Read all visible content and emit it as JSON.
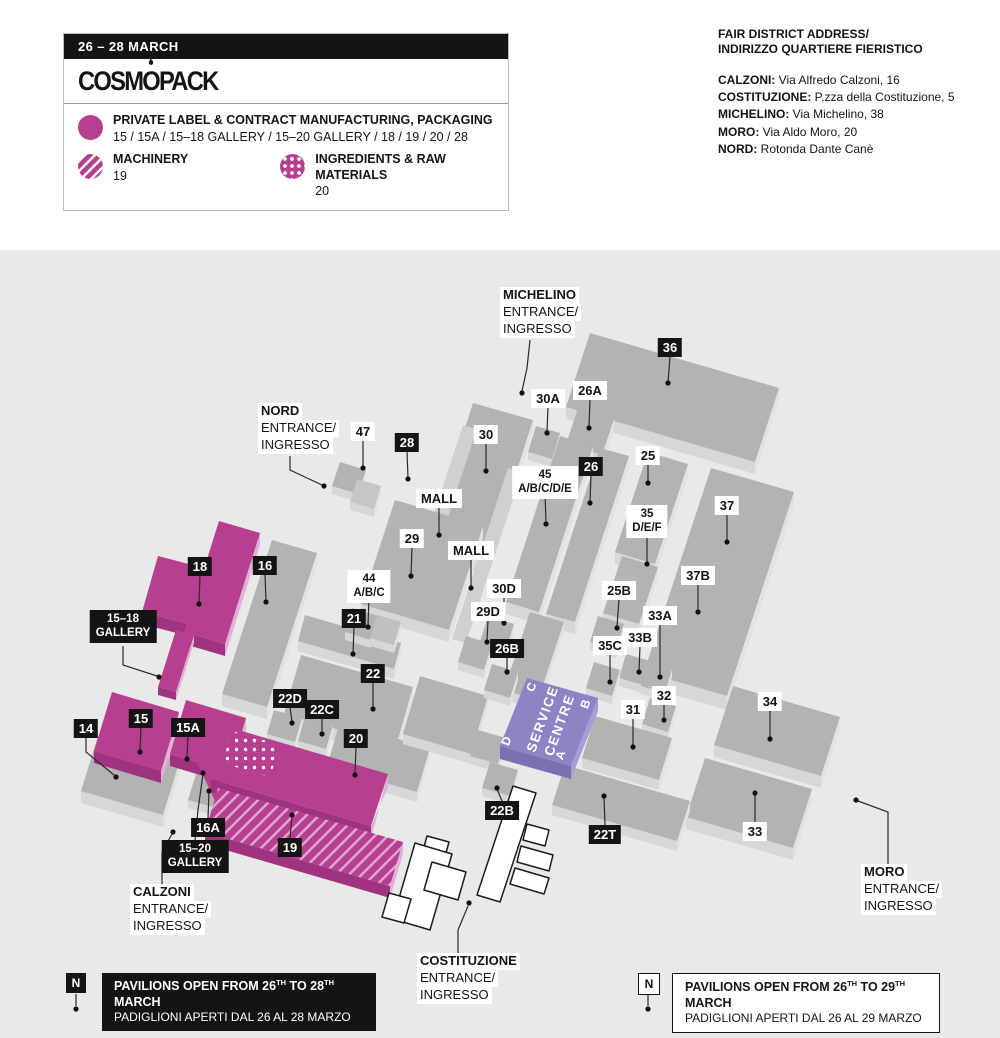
{
  "header": {
    "dates": "26 – 28 MARCH",
    "logo": {
      "part1": "COSM",
      "o": "O",
      "part2": "PACK"
    },
    "legend": [
      {
        "icon": "solid-circle",
        "title": "PRIVATE LABEL & CONTRACT MANUFACTURING, PACKAGING",
        "halls": "15 / 15A / 15–18 GALLERY / 15–20 GALLERY / 18 / 19 / 20 / 28"
      },
      {
        "icon": "striped-circle",
        "title": "MACHINERY",
        "halls": "19"
      },
      {
        "icon": "dotted-circle",
        "title": "INGREDIENTS & RAW MATERIALS",
        "halls": "20"
      }
    ]
  },
  "address": {
    "title1": "FAIR DISTRICT ADDRESS/",
    "title2": "INDIRIZZO QUARTIERE FIERISTICO",
    "entries": [
      {
        "name": "CALZONI:",
        "value": " Via Alfredo Calzoni, 16"
      },
      {
        "name": "COSTITUZIONE:",
        "value": " P.zza della Costituzione, 5"
      },
      {
        "name": "MICHELINO:",
        "value": " Via Michelino, 38"
      },
      {
        "name": "MORO:",
        "value": " Via Aldo Moro, 20"
      },
      {
        "name": "NORD:",
        "value": " Rotonda Dante Canè"
      }
    ]
  },
  "map": {
    "colors": {
      "magenta": "#b6408f",
      "gray": "#b3b3b3",
      "purple": "#8d83c5"
    },
    "mall": "MALL",
    "words": {
      "entrance": "ENTRANCE/",
      "ingresso": "INGRESSO"
    },
    "entrances": {
      "michelino": "MICHELINO",
      "nord": "NORD",
      "calzoni": "CALZONI",
      "costituzione": "COSTITUZIONE",
      "moro": "MORO"
    },
    "halls": {
      "36": "36",
      "30": "30",
      "47": "47",
      "30A": "30A",
      "26A": "26A",
      "26": "26",
      "25": "25",
      "37": "37",
      "37B": "37B",
      "25B": "25B",
      "33A": "33A",
      "33B": "33B",
      "35C": "35C",
      "32": "32",
      "31": "31",
      "34": "34",
      "33": "33",
      "29": "29",
      "21": "21",
      "22": "22",
      "22C": "22C",
      "22D": "22D",
      "20": "20",
      "19": "19",
      "18": "18",
      "16": "16",
      "15": "15",
      "15A": "15A",
      "16A": "16A",
      "14": "14",
      "28": "28",
      "26B": "26B",
      "30D": "30D",
      "29D": "29D",
      "22B": "22B",
      "22T": "22T"
    },
    "multi": {
      "45": {
        "l1": "45",
        "l2": "A/B/C/D/E"
      },
      "35": {
        "l1": "35",
        "l2": "D/E/F"
      },
      "44": {
        "l1": "44",
        "l2": "A/B/C"
      },
      "g1518": {
        "l1": "15–18",
        "l2": "GALLERY"
      },
      "g1520": {
        "l1": "15–20",
        "l2": "GALLERY"
      }
    },
    "service_centre": {
      "line1": "SERVICE",
      "line2": "CENTRE",
      "a": "A",
      "b": "B",
      "c": "C",
      "d": "D"
    }
  },
  "notes": {
    "n": "N",
    "left": {
      "pre": "PAVILIONS OPEN FROM 26",
      "sup1": "TH",
      "mid": " TO 28",
      "sup2": "TH",
      "post": " MARCH",
      "line2": "PADIGLIONI APERTI DAL 26 AL 28 MARZO"
    },
    "right": {
      "pre": "PAVILIONS OPEN FROM 26",
      "sup1": "TH",
      "mid": " TO 29",
      "sup2": "TH",
      "post": " MARCH",
      "line2": "PADIGLIONI APERTI DAL 26 AL 29 MARZO"
    }
  }
}
